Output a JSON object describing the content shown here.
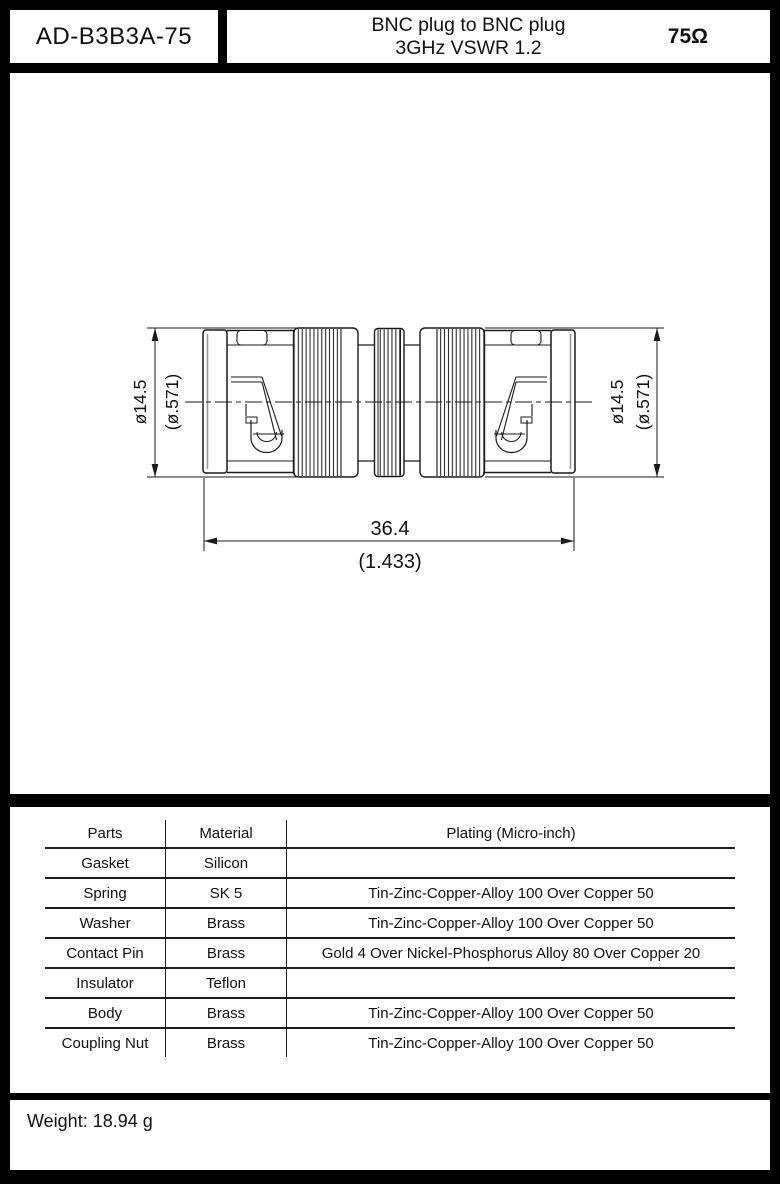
{
  "header": {
    "part_number": "AD-B3B3A-75",
    "title_line1": "BNC plug to BNC plug",
    "title_line2": "3GHz VSWR 1.2",
    "impedance": "75Ω"
  },
  "drawing": {
    "dim_diameter_mm": "ø14.5",
    "dim_diameter_inch": "(ø.571)",
    "dim_length_mm": "36.4",
    "dim_length_inch": "(1.433)"
  },
  "table": {
    "headers": [
      "Parts",
      "Material",
      "Plating (Micro-inch)"
    ],
    "rows": [
      {
        "part": "Gasket",
        "material": "Silicon",
        "plating": ""
      },
      {
        "part": "Spring",
        "material": "SK 5",
        "plating": "Tin-Zinc-Copper-Alloy 100 Over Copper 50"
      },
      {
        "part": "Washer",
        "material": "Brass",
        "plating": "Tin-Zinc-Copper-Alloy 100 Over Copper 50"
      },
      {
        "part": "Contact Pin",
        "material": "Brass",
        "plating": "Gold 4 Over Nickel-Phosphorus Alloy 80 Over Copper 20"
      },
      {
        "part": "Insulator",
        "material": "Teflon",
        "plating": ""
      },
      {
        "part": "Body",
        "material": "Brass",
        "plating": "Tin-Zinc-Copper-Alloy 100 Over Copper 50"
      },
      {
        "part": "Coupling Nut",
        "material": "Brass",
        "plating": "Tin-Zinc-Copper-Alloy 100 Over Copper 50"
      }
    ]
  },
  "footer": {
    "weight": "Weight: 18.94 g"
  },
  "colors": {
    "background": "#000000",
    "panel": "#ffffff",
    "line": "#1a1a1a"
  }
}
